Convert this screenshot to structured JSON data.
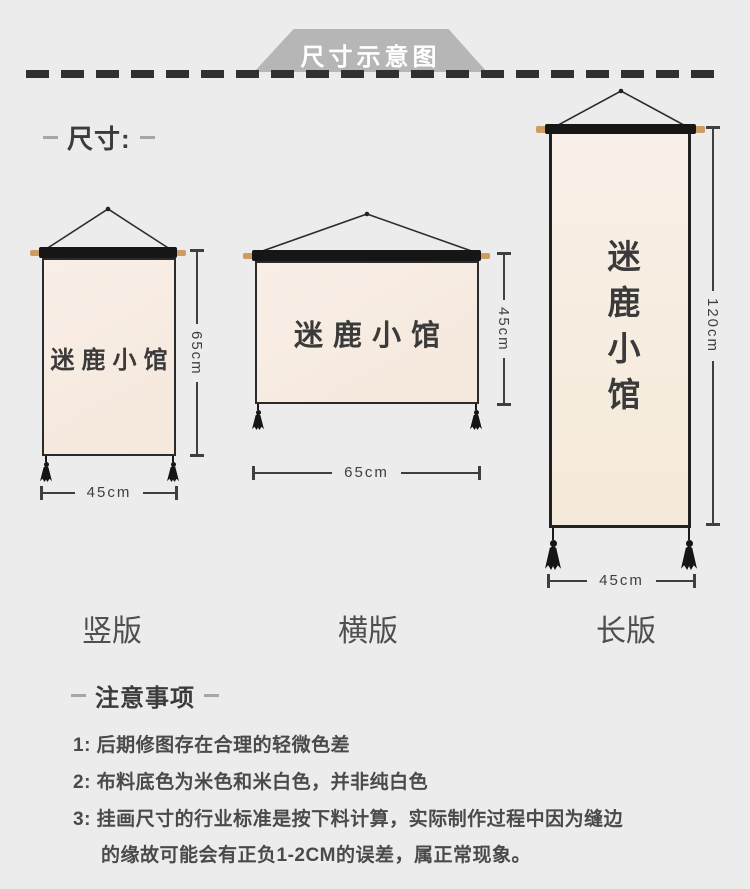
{
  "header": {
    "title": "尺寸示意图"
  },
  "size_section": {
    "label": "尺寸:"
  },
  "scrolls": [
    {
      "type_label": "竖版",
      "brand_text": "迷鹿小馆",
      "height_dim": "65cm",
      "width_dim": "45cm"
    },
    {
      "type_label": "横版",
      "brand_text": "迷鹿小馆",
      "height_dim": "45cm",
      "width_dim": "65cm"
    },
    {
      "type_label": "长版",
      "brand_text": "迷鹿小馆",
      "height_dim": "120cm",
      "width_dim": "45cm"
    }
  ],
  "notes_section": {
    "label": "注意事项",
    "note1": "1: 后期修图存在合理的轻微色差",
    "note2": "2: 布料底色为米色和米白色，并非纯白色",
    "note3_line1": "3: 挂画尺寸的行业标准是按下料计算，实际制作过程中因为缝边",
    "note3_line2": "的缘故可能会有正负1-2CM的误差，属正常现象。"
  },
  "colors": {
    "page_bg": "#ececec",
    "banner_bg": "#b6b6b6",
    "canvas_beige": "#f7ece2",
    "rod_black": "#161616",
    "wood_cap": "#cf9c62",
    "ink": "#3f3f3f"
  }
}
